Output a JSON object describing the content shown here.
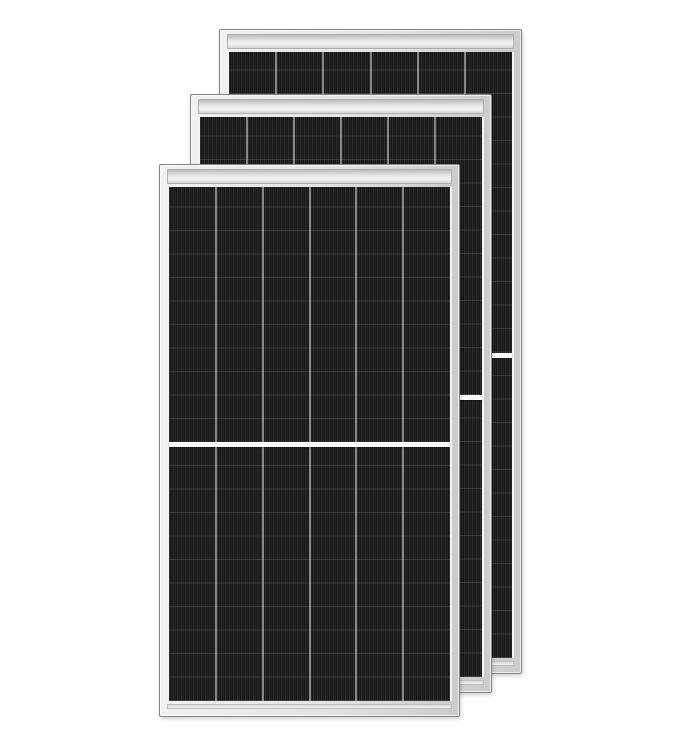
{
  "scene": {
    "background_color": "#ffffff",
    "visible_text": ""
  },
  "colors": {
    "background": "#ffffff",
    "frame_fill": "#e3e3e3",
    "frame_outline": "#848484",
    "rail_fill": "#f3f3f3",
    "cell_dark": "#171717",
    "half_divider": "#f8f8f8"
  },
  "panels": [
    {
      "id": "back",
      "left": 219,
      "top": 29,
      "width": 303,
      "height": 645,
      "z": 1,
      "columns": 6
    },
    {
      "id": "middle",
      "left": 190,
      "top": 94,
      "width": 302,
      "height": 599,
      "z": 2,
      "columns": 6
    },
    {
      "id": "front",
      "left": 159,
      "top": 164,
      "width": 301,
      "height": 553,
      "z": 3,
      "columns": 6
    }
  ]
}
